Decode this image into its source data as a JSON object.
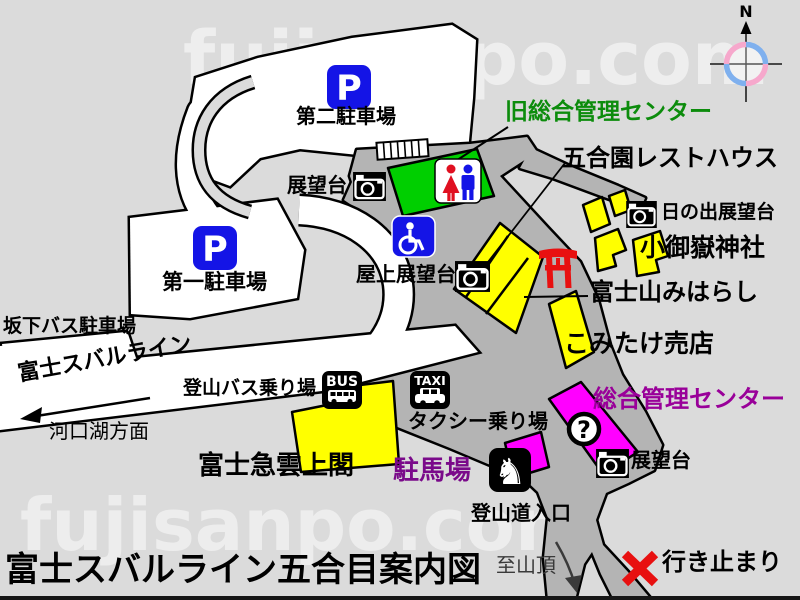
{
  "title": "富士スバルライン五合目案内図",
  "watermark": "fujisanpo.com",
  "compass": {
    "north": "N"
  },
  "colors": {
    "background": "#dbdbdb",
    "road": "#ffffff",
    "plaza": "#b4b4b4",
    "building_yellow": "#ffff00",
    "building_green": "#00cf00",
    "building_magenta": "#ff00ff",
    "icon_blue": "#1414e6",
    "accent_red": "#e81010",
    "label_green": "#0c8c0c",
    "label_purple": "#990099",
    "horse_purple": "#7a0a8a"
  },
  "labels": {
    "parking2": "第二駐車場",
    "parking1": "第一駐車場",
    "viewpoint_upper": "展望台",
    "old_management_center": "旧総合管理センター",
    "gogoen_rest_house": "五合園レストハウス",
    "hinode_viewpoint": "日の出展望台",
    "komitake_shrine": "小御嶽神社",
    "rooftop_viewpoint": "屋上展望台",
    "fujisan_miharashi": "富士山みはらし",
    "komitake_shop": "こみたけ売店",
    "sakashita_bus_parking": "坂下バス駐車場",
    "fuji_subaru_line": "富士スバルライン",
    "kawaguchiko_direction": "河口湖方面",
    "climbing_bus_stop": "登山バス乗り場",
    "taxi_stand": "タクシー乗り場",
    "fujikyu_unjokaku": "富士急雲上閣",
    "horse_parking": "駐馬場",
    "management_center": "総合管理センター",
    "viewpoint_lower": "展望台",
    "trail_entrance": "登山道入口",
    "to_summit": "至山頂",
    "dead_end": "行き止まり"
  },
  "icon_labels": {
    "parking": "P",
    "bus": "BUS",
    "taxi": "TAXI",
    "info": "?",
    "horse": "♞"
  }
}
